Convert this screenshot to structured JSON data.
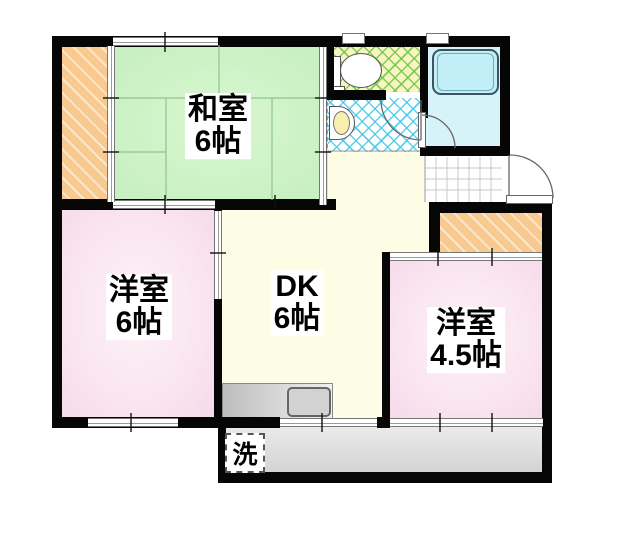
{
  "plan_type": "floor-plan",
  "rooms": {
    "washitsu": {
      "name": "和室",
      "size": "6帖"
    },
    "western6": {
      "name": "洋室",
      "size": "6帖"
    },
    "dk": {
      "name": "DK",
      "size": "6帖"
    },
    "western45": {
      "name": "洋室",
      "size": "4.5帖"
    },
    "laundry": {
      "label": "洗"
    }
  },
  "colors": {
    "wall": "#060606",
    "tatami_green": "#c9f0c2",
    "western_room_pink": "#f9e2ee",
    "dk_cream": "#fdfce4",
    "closet_orange": "#f8ca90",
    "bath_cyan": "#d5f3f8",
    "bathtub_cyan": "#c2eef8",
    "toilet_floor_yellow": "#f8f4c4",
    "toilet_hatch_green": "#68c83e",
    "wash_hatch_cyan": "#40c8e8",
    "balcony_gray": "#dcdcdc"
  }
}
